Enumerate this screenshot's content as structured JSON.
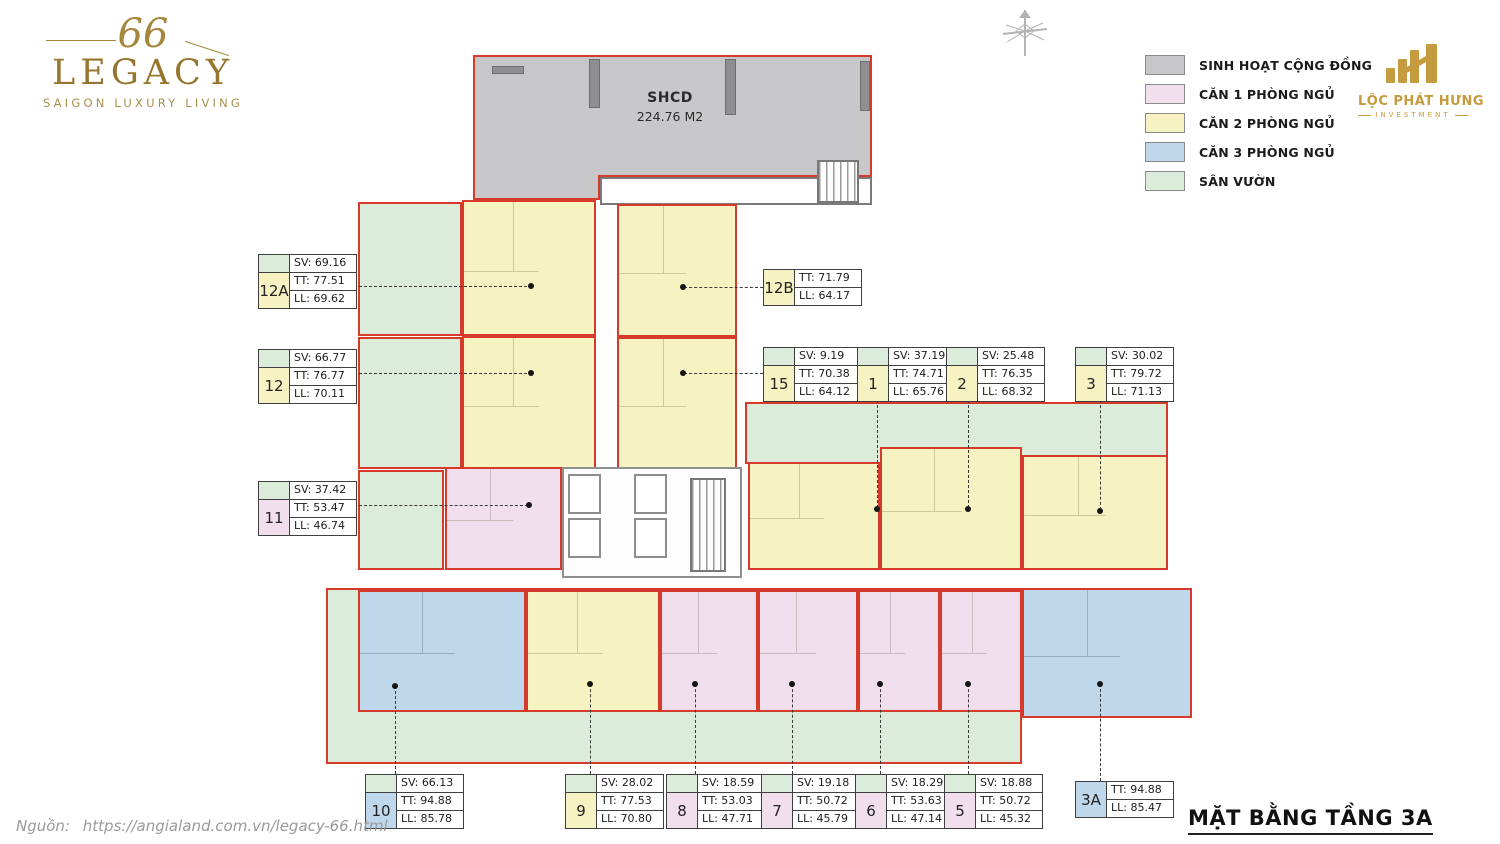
{
  "branding": {
    "project_logo": {
      "number": "66",
      "name": "LEGACY",
      "tagline": "SAIGON LUXURY LIVING"
    },
    "developer_logo": {
      "name": "LỘC PHÁT HƯNG",
      "subtitle": "INVESTMENT"
    }
  },
  "legend": {
    "items": [
      {
        "key": "community",
        "label": "SINH HOẠT CỘNG ĐỒNG",
        "color": "#c8c8ca"
      },
      {
        "key": "1br",
        "label": "CĂN 1 PHÒNG NGỦ",
        "color": "#f1dfee"
      },
      {
        "key": "2br",
        "label": "CĂN 2 PHÒNG NGỦ",
        "color": "#f7f2c2"
      },
      {
        "key": "3br",
        "label": "CĂN 3 PHÒNG NGỦ",
        "color": "#bfd7eb"
      },
      {
        "key": "garden",
        "label": "SÂN VƯỜN",
        "color": "#dcecdb"
      }
    ]
  },
  "floor_plan": {
    "title": "MẶT BẰNG TẦNG 3A",
    "accent_border_color": "#d63a2b",
    "shcd": {
      "name": "SHCD",
      "area": "224.76 M2"
    },
    "units": [
      {
        "id": "12A",
        "type": "2br",
        "sv": "SV: 69.16",
        "tt": "TT: 77.51",
        "ll": "LL: 69.62"
      },
      {
        "id": "12",
        "type": "2br",
        "sv": "SV: 66.77",
        "tt": "TT: 76.77",
        "ll": "LL: 70.11"
      },
      {
        "id": "11",
        "type": "1br",
        "sv": "SV: 37.42",
        "tt": "TT: 53.47",
        "ll": "LL: 46.74"
      },
      {
        "id": "12B",
        "type": "2br",
        "tt": "TT: 71.79",
        "ll": "LL: 64.17"
      },
      {
        "id": "15",
        "type": "2br",
        "sv": "SV: 9.19",
        "tt": "TT: 70.38",
        "ll": "LL: 64.12"
      },
      {
        "id": "1",
        "type": "2br",
        "sv": "SV: 37.19",
        "tt": "TT: 74.71",
        "ll": "LL: 65.76"
      },
      {
        "id": "2",
        "type": "2br",
        "sv": "SV: 25.48",
        "tt": "TT: 76.35",
        "ll": "LL: 68.32"
      },
      {
        "id": "3",
        "type": "2br",
        "sv": "SV: 30.02",
        "tt": "TT: 79.72",
        "ll": "LL: 71.13"
      },
      {
        "id": "10",
        "type": "3br",
        "sv": "SV: 66.13",
        "tt": "TT: 94.88",
        "ll": "LL: 85.78"
      },
      {
        "id": "9",
        "type": "2br",
        "sv": "SV: 28.02",
        "tt": "TT: 77.53",
        "ll": "LL: 70.80"
      },
      {
        "id": "8",
        "type": "1br",
        "sv": "SV: 18.59",
        "tt": "TT: 53.03",
        "ll": "LL: 47.71"
      },
      {
        "id": "7",
        "type": "1br",
        "sv": "SV: 19.18",
        "tt": "TT: 50.72",
        "ll": "LL: 45.79"
      },
      {
        "id": "6",
        "type": "1br",
        "sv": "SV: 18.29",
        "tt": "TT: 53.63",
        "ll": "LL: 47.14"
      },
      {
        "id": "5",
        "type": "1br",
        "sv": "SV: 18.88",
        "tt": "TT: 50.72",
        "ll": "LL: 45.32"
      },
      {
        "id": "3A",
        "type": "3br",
        "tt": "TT: 94.88",
        "ll": "LL: 85.47"
      }
    ]
  },
  "footer": {
    "source_label": "Nguồn:",
    "source_url": "https://angialand.com.vn/legacy-66.html"
  }
}
